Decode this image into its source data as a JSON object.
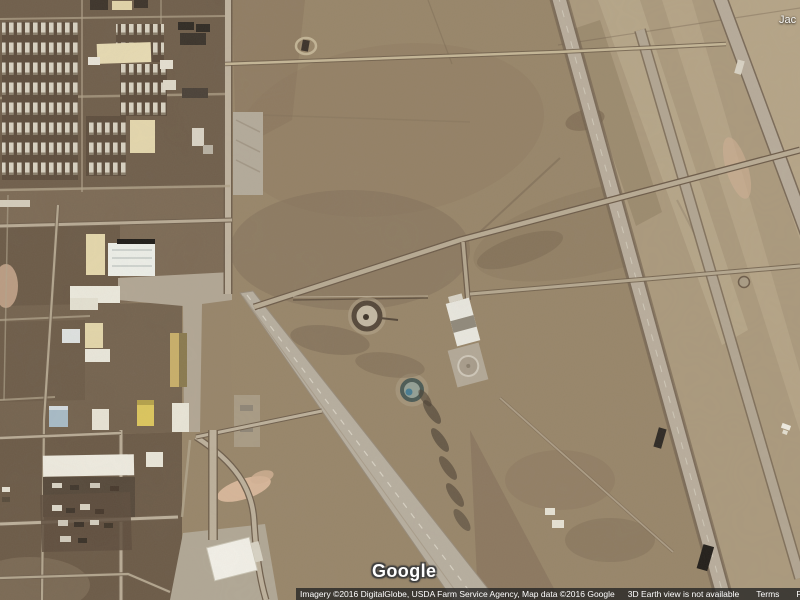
{
  "map": {
    "watermark": "Google",
    "partial_place_label": "Jac"
  },
  "attribution": {
    "credits": "Imagery ©2016 DigitalGlobe, USDA Farm Service Agency, Map data ©2016 Google",
    "notice": "3D Earth view is not available",
    "links": [
      {
        "label": "Terms"
      },
      {
        "label": "Privacy"
      },
      {
        "label": "Send feedback"
      }
    ]
  },
  "colors": {
    "desert_base": "#98866a",
    "desert_light": "#b2a183",
    "desert_dark": "#6e5c49",
    "road_paved": "#b9ae9d",
    "road_dirt": "#c5b797",
    "building_white": "#f0ede3",
    "building_cream": "#e8dcb4",
    "building_yellow": "#dcc65e",
    "building_blue": "#a8bcc8",
    "attribution_bg": "#222222",
    "text_color": "#ffffff"
  }
}
